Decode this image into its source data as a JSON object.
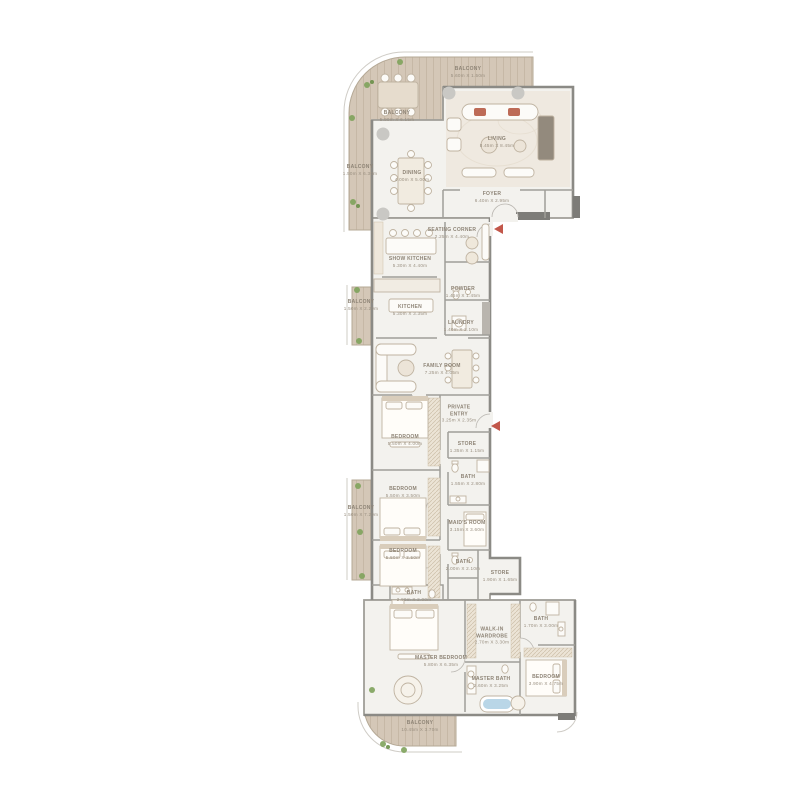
{
  "plan": {
    "colors": {
      "deck_wood": "#d4c7b7",
      "deck_plank_line": "#c3b5a2",
      "interior_floor": "#f3f2ee",
      "marble_floor": "#efe9e0",
      "wall": "#9f9d97",
      "outer_wall": "#8b8a85",
      "furniture_stroke": "#bfb3a1",
      "wardrobe_hatch": "#cdbfa9",
      "label_text": "#8e8476",
      "plant_green": "#7fa35c",
      "entry_arrow_red": "#c2574a",
      "bath_water_blue": "#b9d6e7"
    },
    "icons": {
      "plant": "plant-icon",
      "entry_marker": "entry-arrow-icon",
      "column": "structural-column-icon"
    }
  },
  "rooms": [
    {
      "name": "BALCONY",
      "dims": "5.60m X 1.50m"
    },
    {
      "name": "BALCONY",
      "dims": "5.90m X 6.15m"
    },
    {
      "name": "BALCONY",
      "dims": "1.50m X 6.30m"
    },
    {
      "name": "LIVING",
      "dims": "8.45m X 8.45m"
    },
    {
      "name": "DINING",
      "dims": "4.00m X 5.00m"
    },
    {
      "name": "FOYER",
      "dims": "6.40m X 2.95m"
    },
    {
      "name": "SEATING CORNER",
      "dims": "2.25m X 4.40m"
    },
    {
      "name": "SHOW KITCHEN",
      "dims": "5.30m X 4.40m"
    },
    {
      "name": "POWDER",
      "dims": "1.45m X 1.45m"
    },
    {
      "name": "KITCHEN",
      "dims": "5.30m X 3.35m"
    },
    {
      "name": "LAUNDRY",
      "dims": "1.40m X 2.10m"
    },
    {
      "name": "BALCONY",
      "dims": "1.50m X 2.20m"
    },
    {
      "name": "FAMILY ROOM",
      "dims": "7.25m X 4.05m"
    },
    {
      "name": "PRIVATE ENTRY",
      "dims": "3.25m X 2.35m"
    },
    {
      "name": "BEDROOM",
      "dims": "5.50m X 4.00m"
    },
    {
      "name": "STORE",
      "dims": "1.35m X 1.15m"
    },
    {
      "name": "BATH",
      "dims": "1.55m X 2.80m"
    },
    {
      "name": "BALCONY",
      "dims": "1.50m X 7.20m"
    },
    {
      "name": "BEDROOM",
      "dims": "5.50m X 3.50m"
    },
    {
      "name": "MAID'S ROOM",
      "dims": "3.15m X 3.60m"
    },
    {
      "name": "BEDROOM",
      "dims": "5.50m X 3.50m"
    },
    {
      "name": "BATH",
      "dims": "2.00m X 2.10m"
    },
    {
      "name": "STORE",
      "dims": "1.90m X 1.65m"
    },
    {
      "name": "BATH",
      "dims": "2.90m X 2.00m"
    },
    {
      "name": "WALK-IN WARDROBE",
      "dims": "2.70m X 3.30m"
    },
    {
      "name": "BATH",
      "dims": "1.70m X 3.00m"
    },
    {
      "name": "MASTER BEDROOM",
      "dims": "5.80m X 6.35m"
    },
    {
      "name": "MASTER BATH",
      "dims": "2.60m X 3.25m"
    },
    {
      "name": "BEDROOM",
      "dims": "3.90m X 4.75m"
    },
    {
      "name": "BALCONY",
      "dims": "10.45m X 3.70m"
    }
  ]
}
